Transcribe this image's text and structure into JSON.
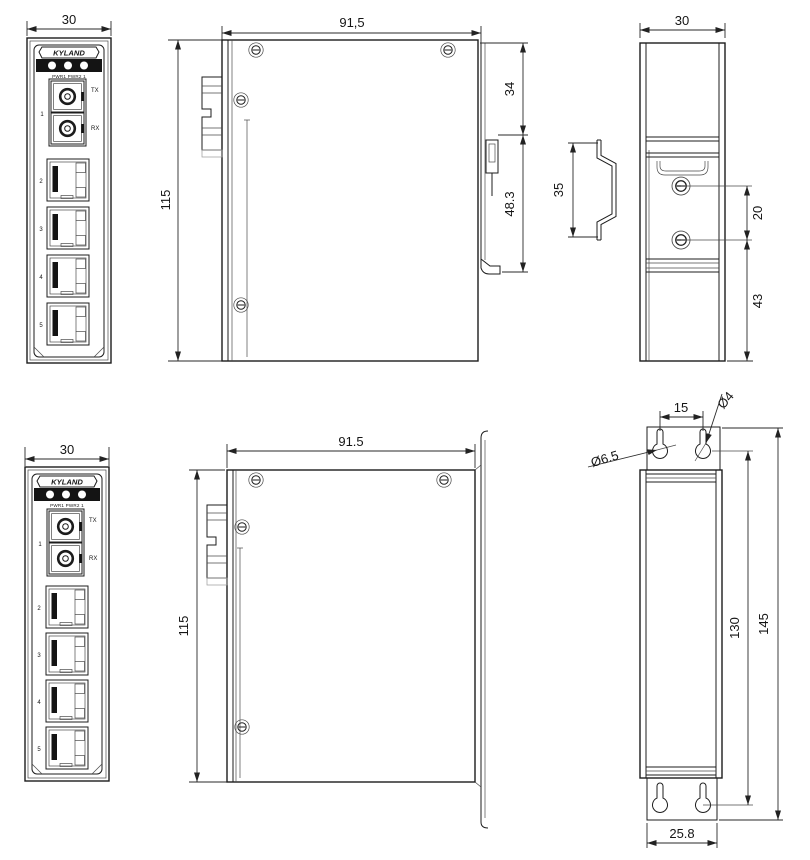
{
  "views": {
    "front_panel": {
      "brand": "KYLAND",
      "led_labels": "PWR1 PWR2 1",
      "fiber_port": "1",
      "tx": "TX",
      "rx": "RX",
      "ports": [
        "2",
        "3",
        "4",
        "5"
      ]
    },
    "front_top": {
      "width_dim": "30"
    },
    "front_bottom": {
      "width_dim": "30"
    },
    "side_top": {
      "width_dim": "91,5",
      "height_dim": "115",
      "din_offset_dim": "34",
      "din_clip_dim": "48.3"
    },
    "side_bottom": {
      "width_dim": "91.5",
      "height_dim": "115"
    },
    "din_rail_profile": {
      "height_dim": "35"
    },
    "rear_top": {
      "width_dim": "30",
      "screw_spacing_dim": "20",
      "bottom_offset_dim": "43"
    },
    "rear_bottom": {
      "slot_spacing_dim": "15",
      "small_hole_dim": "Ø4",
      "large_hole_dim": "Ø6.5",
      "hole_span_dim": "130",
      "plate_height_dim": "145",
      "plate_width_dim": "25.8"
    }
  }
}
